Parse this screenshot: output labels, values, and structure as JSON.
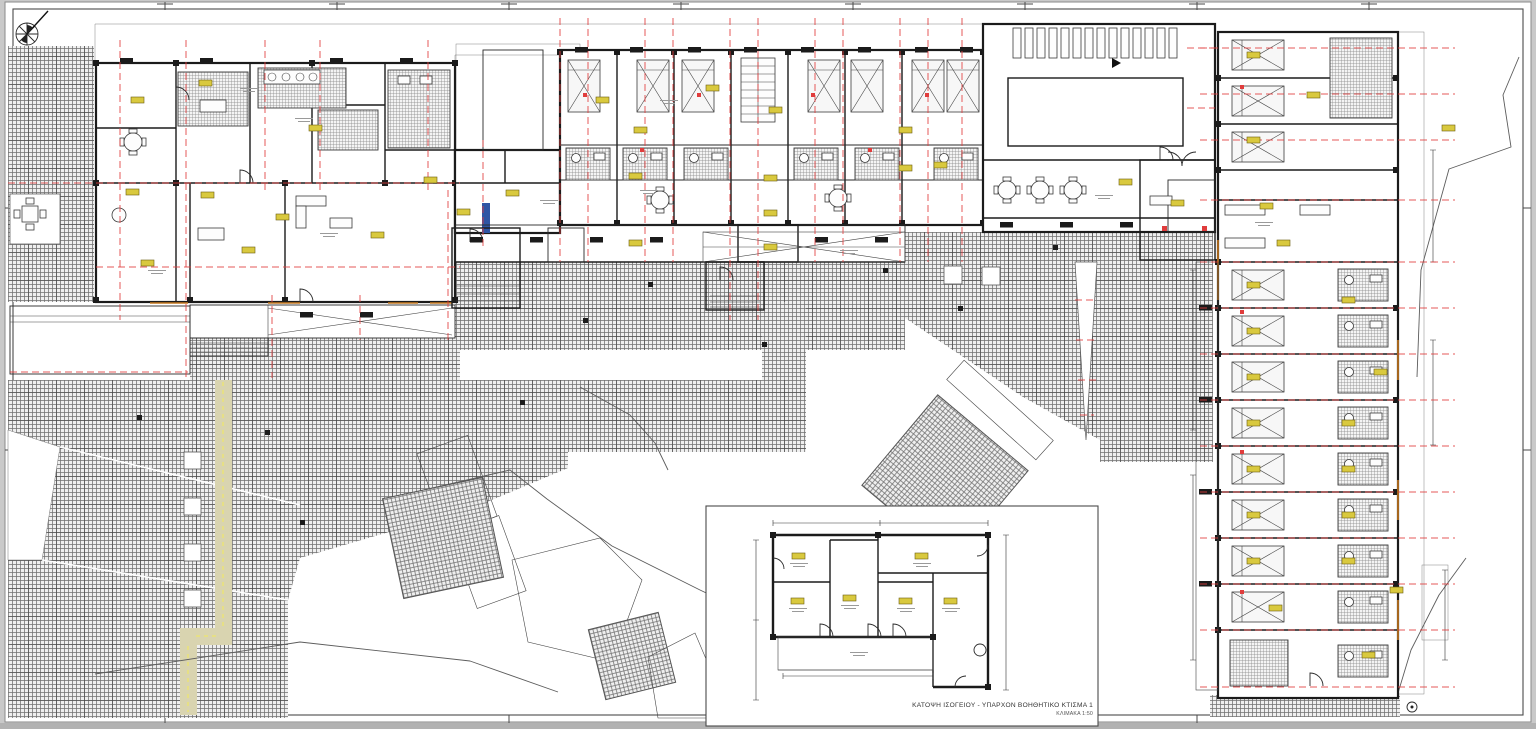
{
  "inset": {
    "caption": "ΚΑΤΟΨΗ ΙΣΟΓΕΙΟΥ - ΥΠΑΡΧΟΝ ΒΟΗΘΗΤΙΚΟ ΚΤΙΣΜΑ 1",
    "scale_note": "ΚΛΙΜΑΚΑ 1:50"
  },
  "icons": {
    "north": "compass-north-icon"
  },
  "colors": {
    "axis_red": "#e03c3c",
    "tag_yellow": "#d9c93e",
    "path_beige": "#d9d4b0",
    "path_dash": "#e6df86",
    "wall_black": "#1b1b1b",
    "hatch_gray": "#707070",
    "window_orange": "#c87a20",
    "paper_white": "#ffffff",
    "margin_gray": "#c9c9c9"
  }
}
